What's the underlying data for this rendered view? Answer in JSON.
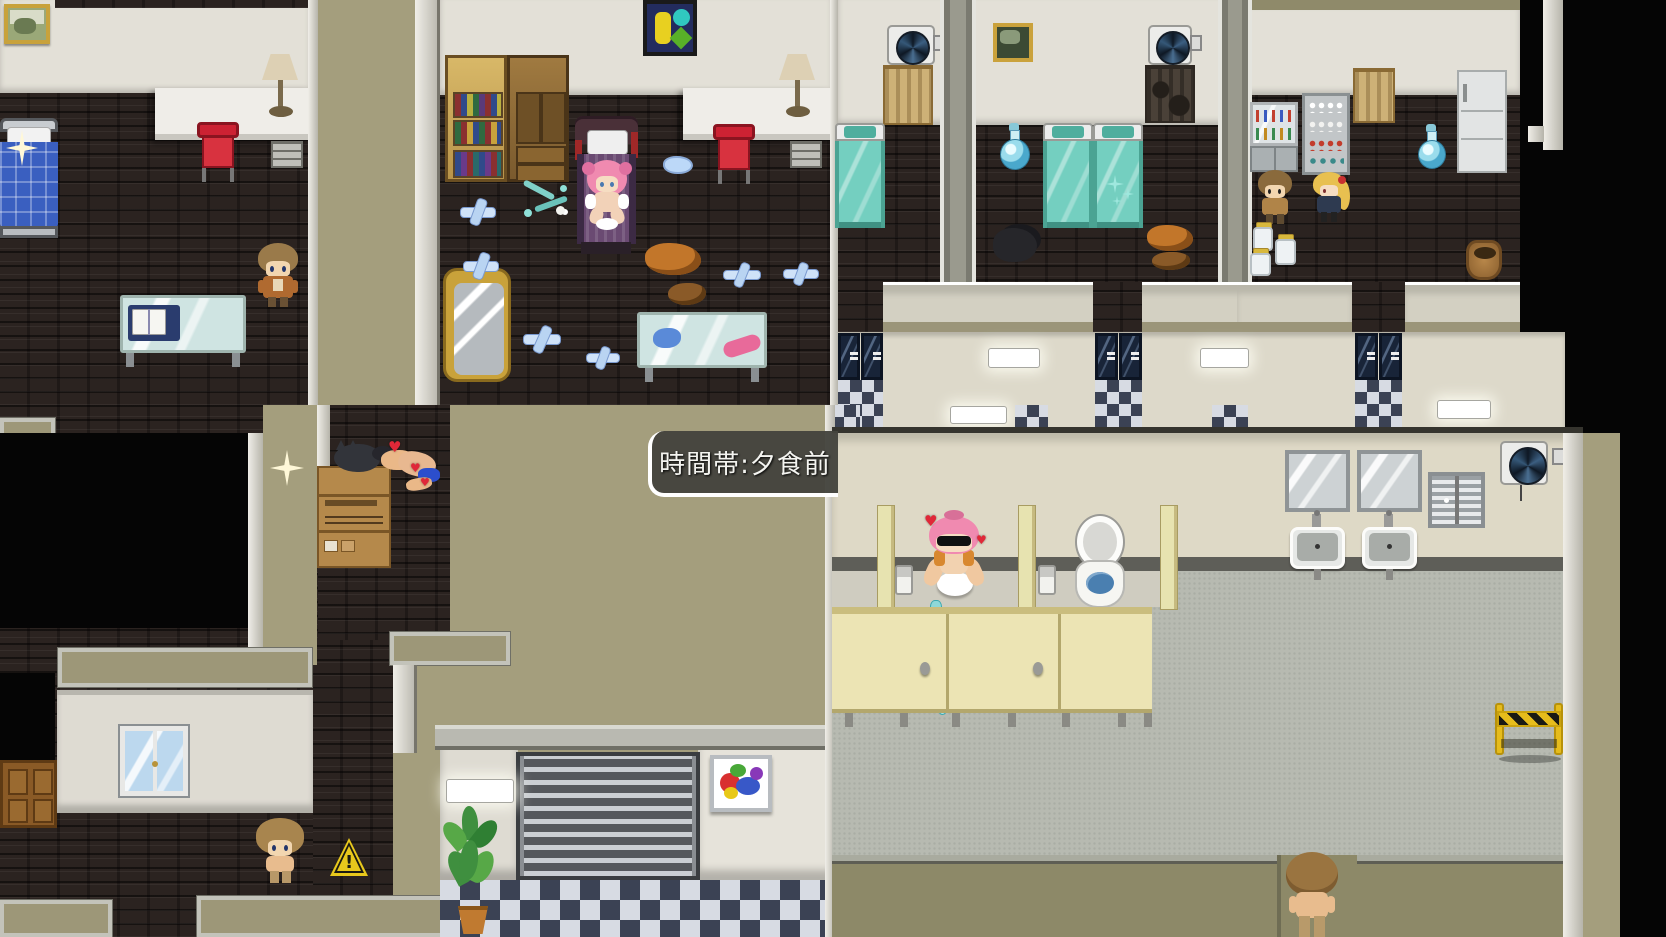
{
  "hud": {
    "time_banner": "時間帯:夕食前"
  },
  "icons": {
    "heart": "♥",
    "exclamation": "!"
  },
  "colors": {
    "brick_floor": "#2b2320",
    "khaki_roof": "#a49e7d",
    "wall_white": "#e3e0d7",
    "corridor_cream": "#ddd9ca",
    "teal_bed": "#74cfc0",
    "blue_bed": "#3a5fc0",
    "checker_dark": "#3b4254",
    "checker_light": "#d7dbe3",
    "stall_cream": "#ece4b4",
    "bathroom_floor": "#b7bab1",
    "door_navy": "#182438",
    "textbox_bg": "#45453d",
    "hazard_yellow": "#e6bc1c",
    "heart_red": "#e02838"
  }
}
